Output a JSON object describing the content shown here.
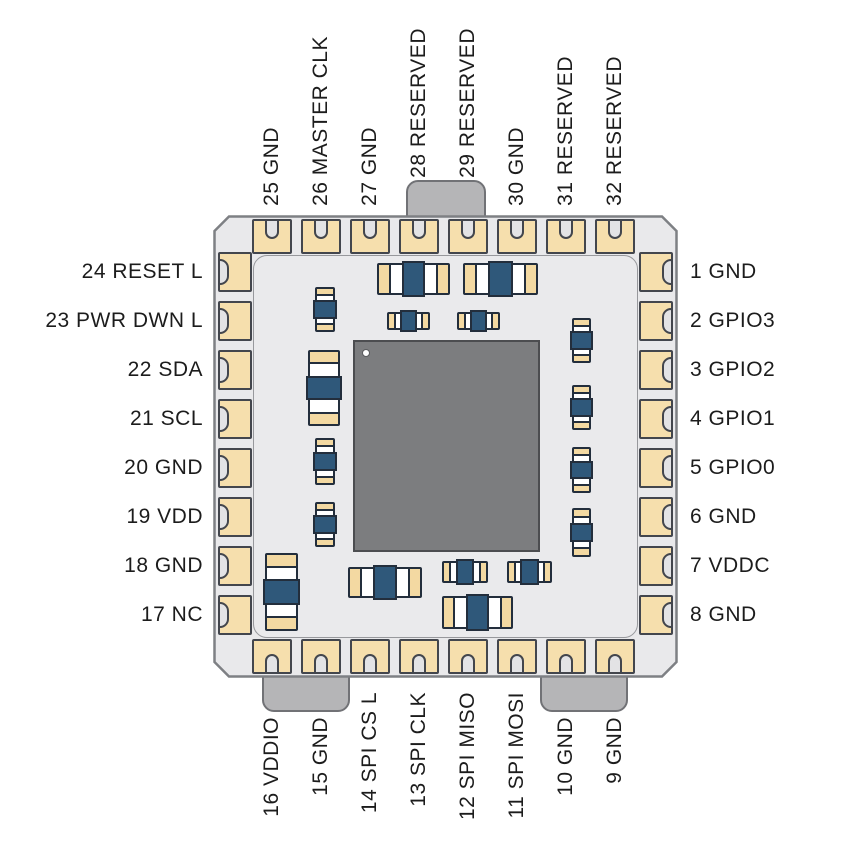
{
  "figure": {
    "type": "chip-package-pinout-diagram",
    "description": "32-pin LCC/QFN style module top view with internal die and decoupling capacitors",
    "pin_count": 32
  },
  "pins": {
    "top_left_to_right": [
      "25 GND",
      "26 MASTER CLK",
      "27 GND",
      "28 RESERVED",
      "29 RESERVED",
      "30 GND",
      "31 RESERVED",
      "32 RESERVED"
    ],
    "right_top_to_bottom": [
      "1 GND",
      "2 GPIO3",
      "3 GPIO2",
      "4 GPIO1",
      "5 GPIO0",
      "6 GND",
      "7 VDDC",
      "8 GND"
    ],
    "left_top_to_bottom": [
      "24 RESET L",
      "23 PWR DWN L",
      "22 SDA",
      "21 SCL",
      "20 GND",
      "19 VDD",
      "18 GND",
      "17 NC"
    ],
    "bottom_left_to_right": [
      "16 VDDIO",
      "15 GND",
      "14 SPI CS L",
      "13 SPI CLK",
      "12 SPI MISO",
      "11 SPI MOSI",
      "10 GND",
      "9 GND"
    ]
  },
  "die": {
    "marker": "pin-1 white dot, top-left corner"
  },
  "tabs": {
    "top_count": 1,
    "bottom_count": 2
  },
  "components": {
    "coordinate_space": "package-relative-px",
    "capacitors": [
      {
        "orient": "h",
        "size": "large",
        "x": 164,
        "y": 48,
        "w": 73,
        "h": 32
      },
      {
        "orient": "h",
        "size": "large",
        "x": 250,
        "y": 48,
        "w": 75,
        "h": 32
      },
      {
        "orient": "h",
        "size": "small",
        "x": 174,
        "y": 97,
        "w": 43,
        "h": 18
      },
      {
        "orient": "h",
        "size": "small",
        "x": 244,
        "y": 97,
        "w": 43,
        "h": 18
      },
      {
        "orient": "v",
        "size": "small",
        "x": 102,
        "y": 72,
        "w": 20,
        "h": 45
      },
      {
        "orient": "v",
        "size": "large",
        "x": 95,
        "y": 135,
        "w": 32,
        "h": 76
      },
      {
        "orient": "v",
        "size": "small",
        "x": 102,
        "y": 223,
        "w": 20,
        "h": 47
      },
      {
        "orient": "v",
        "size": "small",
        "x": 102,
        "y": 287,
        "w": 20,
        "h": 45
      },
      {
        "orient": "v",
        "size": "large",
        "x": 52,
        "y": 338,
        "w": 33,
        "h": 78
      },
      {
        "orient": "h",
        "size": "large",
        "x": 135,
        "y": 352,
        "w": 74,
        "h": 31
      },
      {
        "orient": "h",
        "size": "small",
        "x": 229,
        "y": 346,
        "w": 46,
        "h": 22
      },
      {
        "orient": "h",
        "size": "small",
        "x": 294,
        "y": 346,
        "w": 45,
        "h": 22
      },
      {
        "orient": "h",
        "size": "large",
        "x": 229,
        "y": 381,
        "w": 71,
        "h": 33
      },
      {
        "orient": "v",
        "size": "small",
        "x": 359,
        "y": 103,
        "w": 19,
        "h": 45
      },
      {
        "orient": "v",
        "size": "small",
        "x": 359,
        "y": 170,
        "w": 19,
        "h": 45
      },
      {
        "orient": "v",
        "size": "small",
        "x": 359,
        "y": 232,
        "w": 19,
        "h": 46
      },
      {
        "orient": "v",
        "size": "small",
        "x": 359,
        "y": 293,
        "w": 19,
        "h": 49
      }
    ]
  },
  "colors": {
    "background": "#ffffff",
    "package_fill": "#e9e9eb",
    "package_border": "#7e8084",
    "pad_fill": "#f6dfad",
    "pad_border": "#43464d",
    "notch_fill": "#e3e3e5",
    "tab_fill": "#b5b5b7",
    "tab_border": "#717276",
    "cap_tan": "#f3d9a2",
    "cap_blue": "#2f587a",
    "cap_border": "#232e3c",
    "die_fill": "#7c7d7f",
    "die_border": "#4c4d50",
    "text": "#1c1c1c"
  }
}
